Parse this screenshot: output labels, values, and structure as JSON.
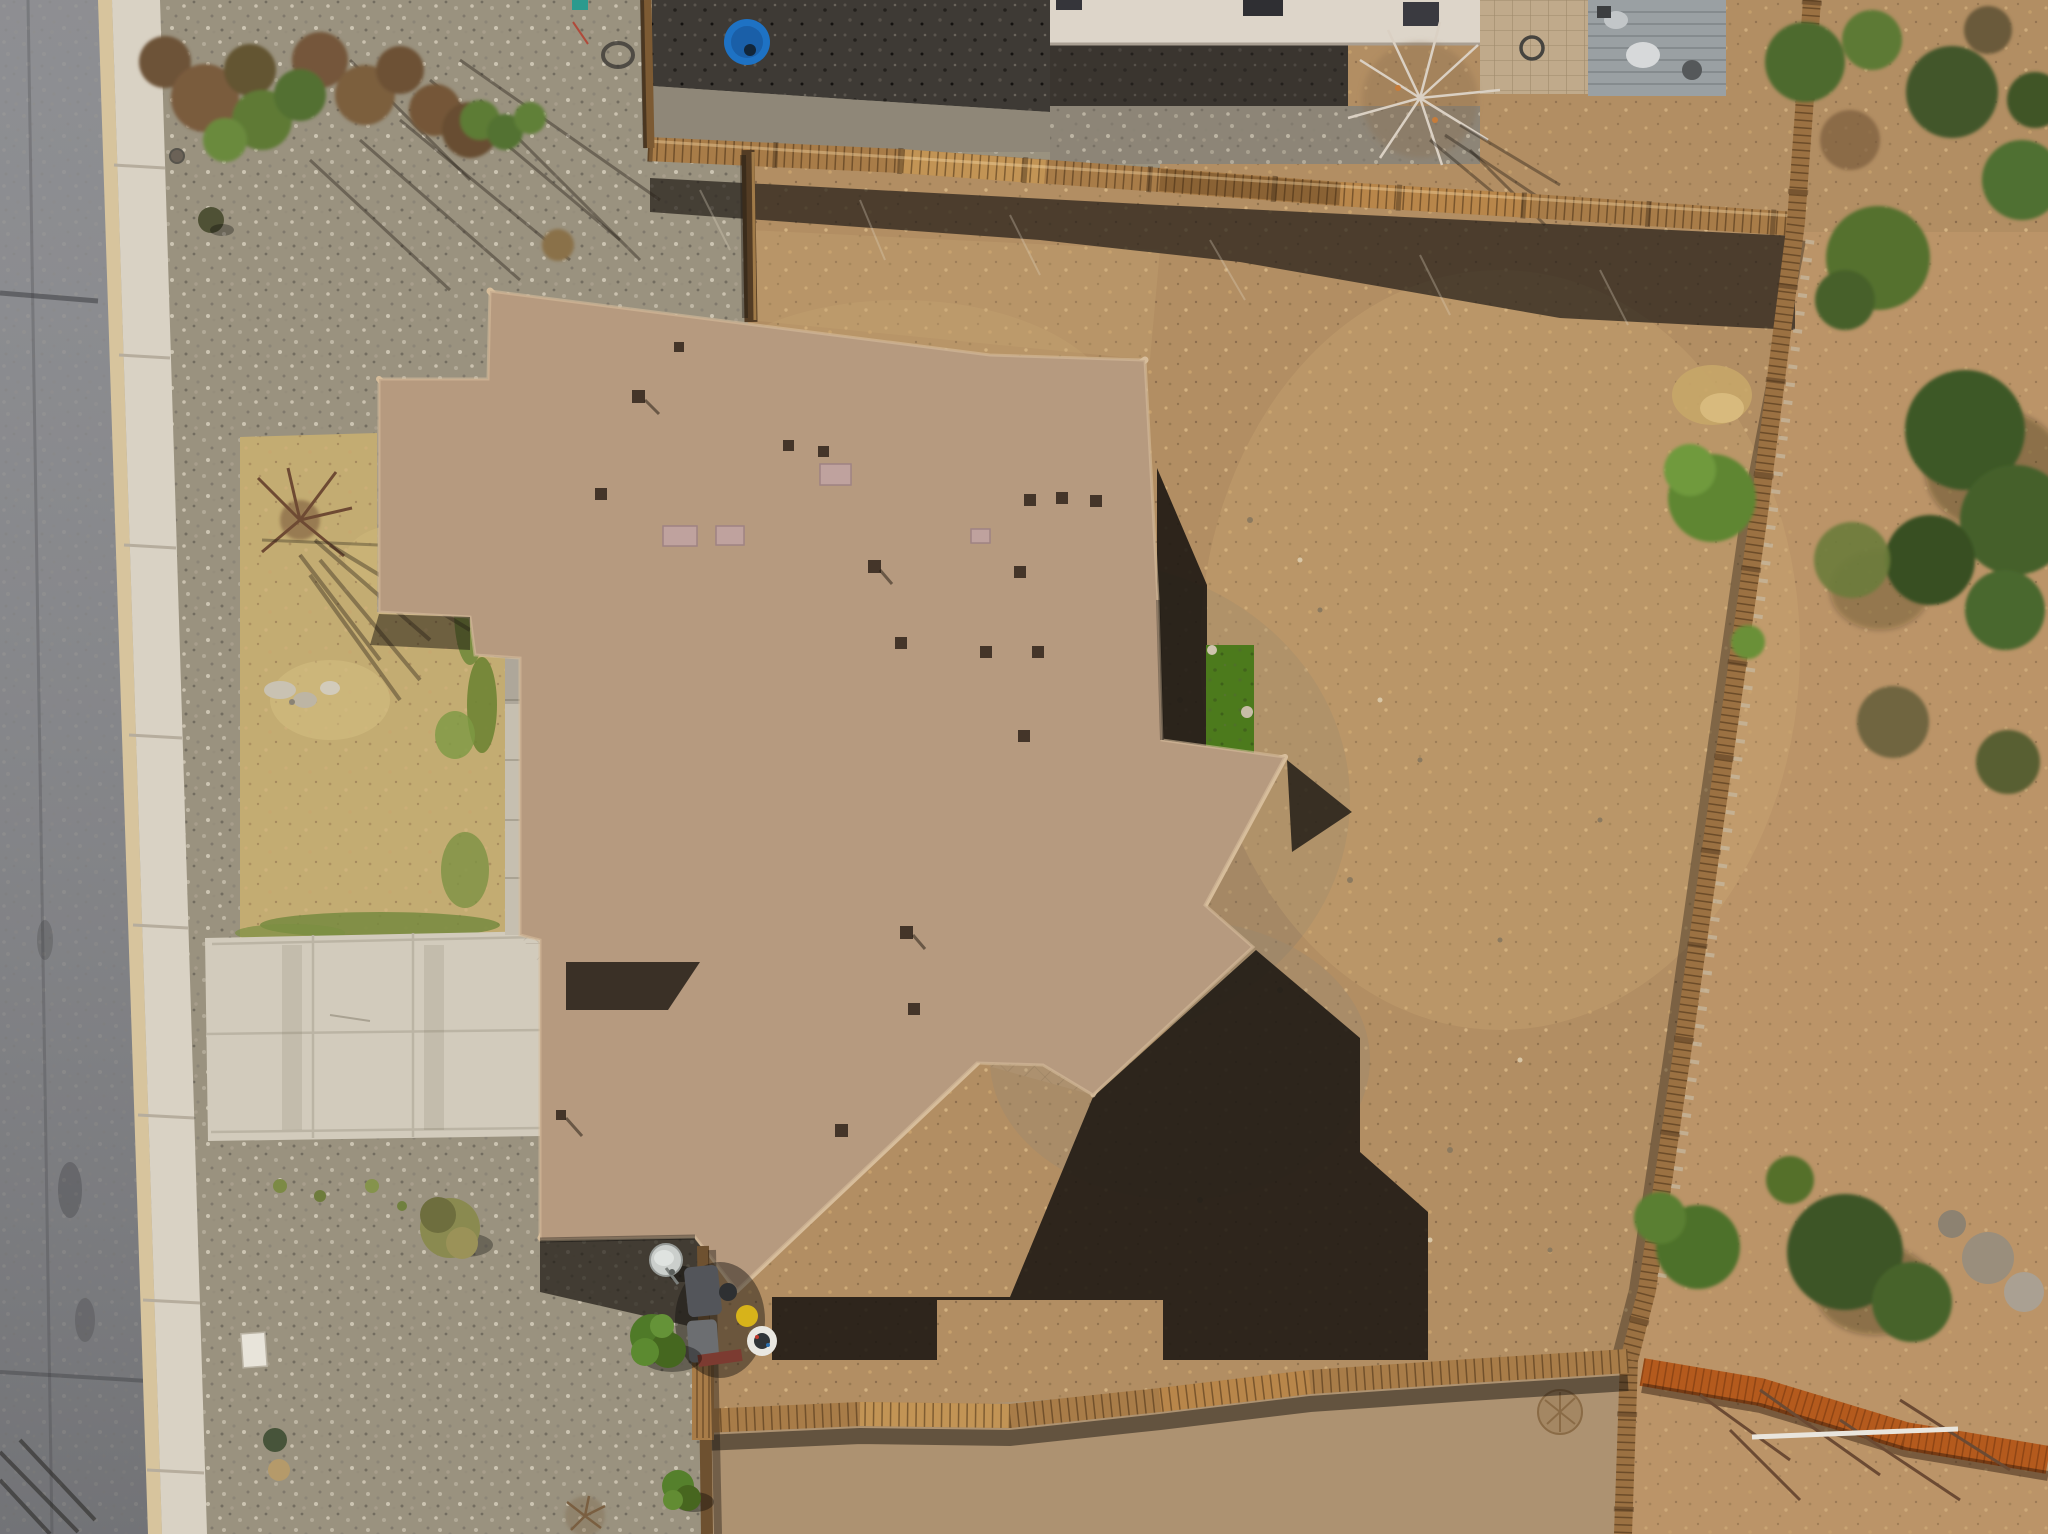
{
  "scene": {
    "type": "aerial-drone-photograph",
    "subject": "Top-down drone view of a single-story house with a tan concrete-tile hip roof, dry desert landscaping, a dirt backyard enclosed by wooden fences, street with sidewalk and concrete driveway on the left, and shrubs and trees along the right slope"
  },
  "palette": {
    "road": "#85868a",
    "curb": "#d7c49d",
    "sidewalk": "#d9d2c4",
    "concrete": "#d2cbbc",
    "concrete_dim": "#c6bfb0",
    "gravel": "#9a927f",
    "gravel_dark": "#3e3a35",
    "gravel_mid": "#8d8577",
    "dirt": "#b28e63",
    "dirt_outer": "#bb9468",
    "dirt_bottom": "#ad9271",
    "lawn": "#c3ac72",
    "turf": "#4c7a1c",
    "roof": "#b69a7f",
    "roof_cap": "#d7bd9b",
    "fence": "#a87c48",
    "fence_new": "#b45a1d",
    "shadow": "#1a1611",
    "white_house": "#ddd5c9",
    "mulch": "#3a352f",
    "paver": "#c0aa8b",
    "deck": "#9aa0a3",
    "pool_blue": "#1e72c4"
  },
  "objects": [
    {
      "name": "asphalt-street"
    },
    {
      "name": "concrete-curb"
    },
    {
      "name": "sidewalk"
    },
    {
      "name": "concrete-driveway"
    },
    {
      "name": "front-walkway"
    },
    {
      "name": "gravel-front-yard"
    },
    {
      "name": "dry-lawn"
    },
    {
      "name": "house-tile-roof"
    },
    {
      "name": "backyard-dirt"
    },
    {
      "name": "artificial-turf-strip"
    },
    {
      "name": "roof-shadow"
    },
    {
      "name": "wood-fence-top"
    },
    {
      "name": "wood-fence-right"
    },
    {
      "name": "wood-fence-bottom"
    },
    {
      "name": "side-yard-fence-gate"
    },
    {
      "name": "new-cedar-fence"
    },
    {
      "name": "neighbor-house"
    },
    {
      "name": "neighbor-paver-patio"
    },
    {
      "name": "neighbor-deck-furniture"
    },
    {
      "name": "blue-kiddie-pool"
    },
    {
      "name": "garden-hose"
    },
    {
      "name": "satellite-dish"
    },
    {
      "name": "trash-bins"
    },
    {
      "name": "front-shrub-cluster"
    },
    {
      "name": "bare-tree-on-lawn"
    },
    {
      "name": "bare-tree-top-right"
    },
    {
      "name": "evergreen-trees-right-slope"
    },
    {
      "name": "round-green-bushes"
    },
    {
      "name": "utility-pad"
    },
    {
      "name": "rock-cluster-on-lawn"
    },
    {
      "name": "straw-clump"
    },
    {
      "name": "tumbleweed"
    },
    {
      "name": "dead-branches-bottom-right"
    }
  ]
}
